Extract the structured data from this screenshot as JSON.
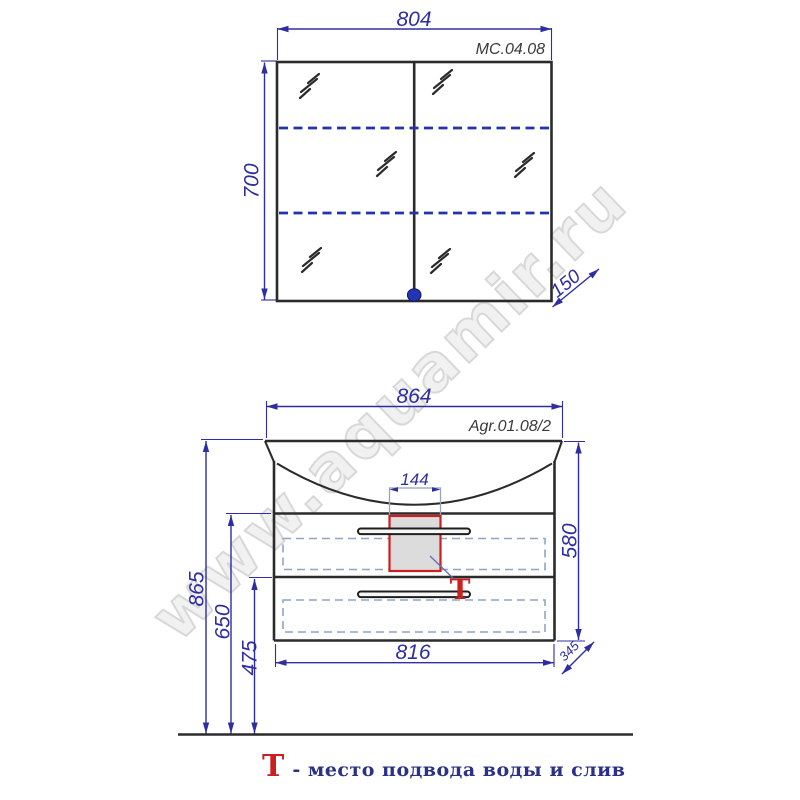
{
  "colors": {
    "dimension": "#2e2ea2",
    "line": "#2b2b2b",
    "shelf": "#2433ab",
    "drawer_dash": "#8fa6c4",
    "red": "#cc1f1f",
    "siphon_fill": "#dcdcdc",
    "label": "#3a3a3a",
    "legend_text": "#2b3185",
    "knob": "#2334b5",
    "watermark": "#d8d8d8"
  },
  "watermark": {
    "text": "www.aquamir.ru"
  },
  "mirror_cabinet": {
    "model": "МС.04.08",
    "width": "804",
    "height": "700",
    "depth": "150"
  },
  "vanity": {
    "model": "Agr.01.08/2",
    "overall_width": "864",
    "siphon_width": "144",
    "body_height": "580",
    "height_total": "865",
    "height_to_top": "650",
    "height_to_divider": "475",
    "body_width": "816",
    "depth": "345",
    "marker": "Т"
  },
  "legend": {
    "symbol": "Т",
    "text": "- место подвода воды и слив"
  }
}
